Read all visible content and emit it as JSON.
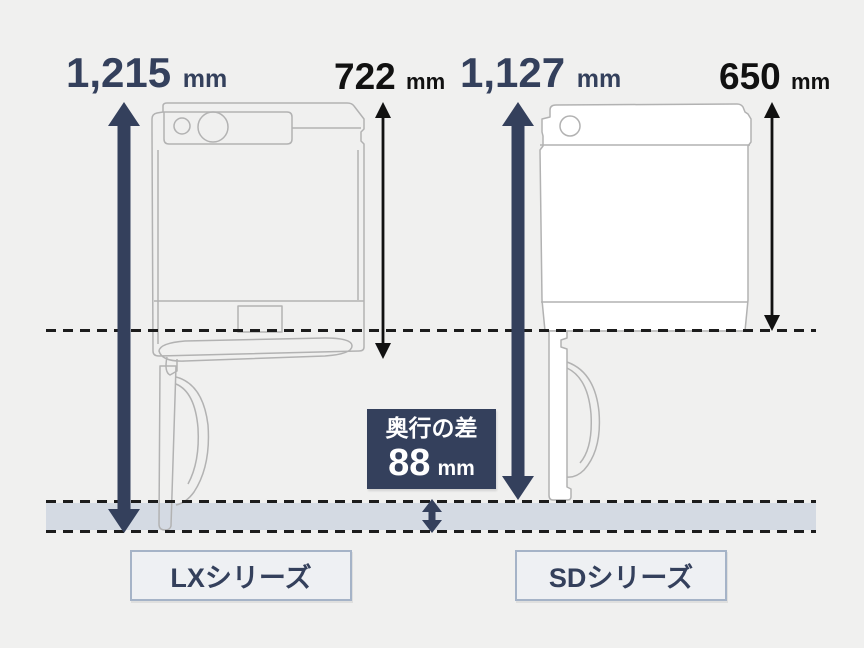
{
  "colors": {
    "background": "#f0f0ef",
    "navy": "#34405c",
    "black": "#111111",
    "band": "#d4dae3",
    "machine_outline": "#b2b2b2",
    "label_border": "#a5b3c7"
  },
  "left_machine": {
    "series_label": "LXシリーズ",
    "total_depth_value": "1,215",
    "total_depth_unit": "mm",
    "body_depth_value": "722",
    "body_depth_unit": "mm"
  },
  "right_machine": {
    "series_label": "SDシリーズ",
    "total_depth_value": "1,127",
    "total_depth_unit": "mm",
    "body_depth_value": "650",
    "body_depth_unit": "mm"
  },
  "difference": {
    "label": "奥行の差",
    "value": "88",
    "unit": "mm"
  }
}
